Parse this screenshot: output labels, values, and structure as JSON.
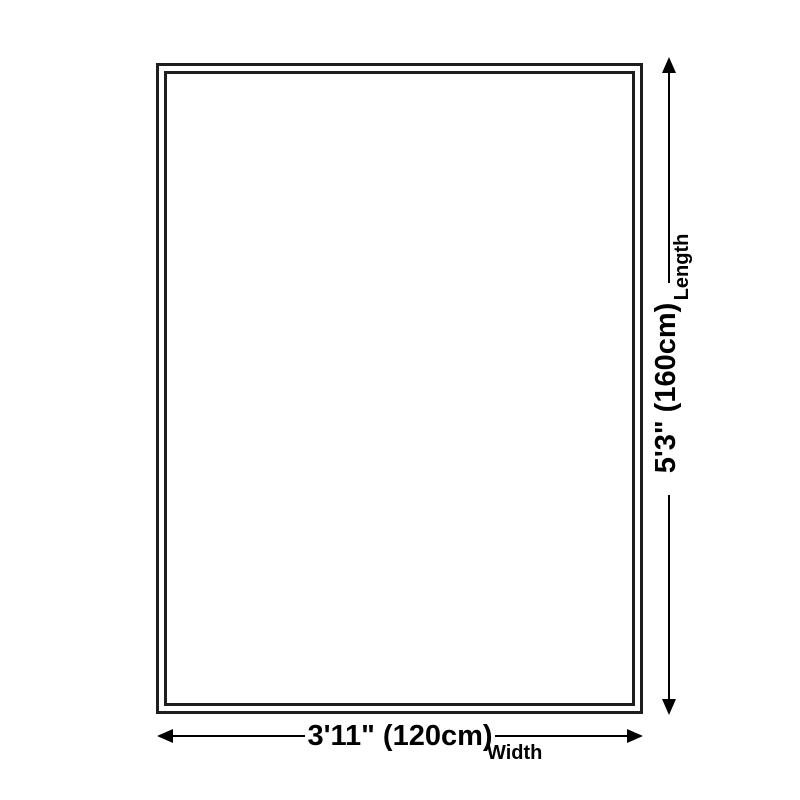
{
  "dimension_diagram": {
    "length": {
      "label": "Length",
      "value": "5'3\" (160cm)"
    },
    "width": {
      "label": "Width",
      "value": "3'11\" (120cm)"
    },
    "colors": {
      "background": "#ffffff",
      "line": "#000000",
      "rug_border": "#1e1e1e",
      "text": "#000000"
    }
  }
}
